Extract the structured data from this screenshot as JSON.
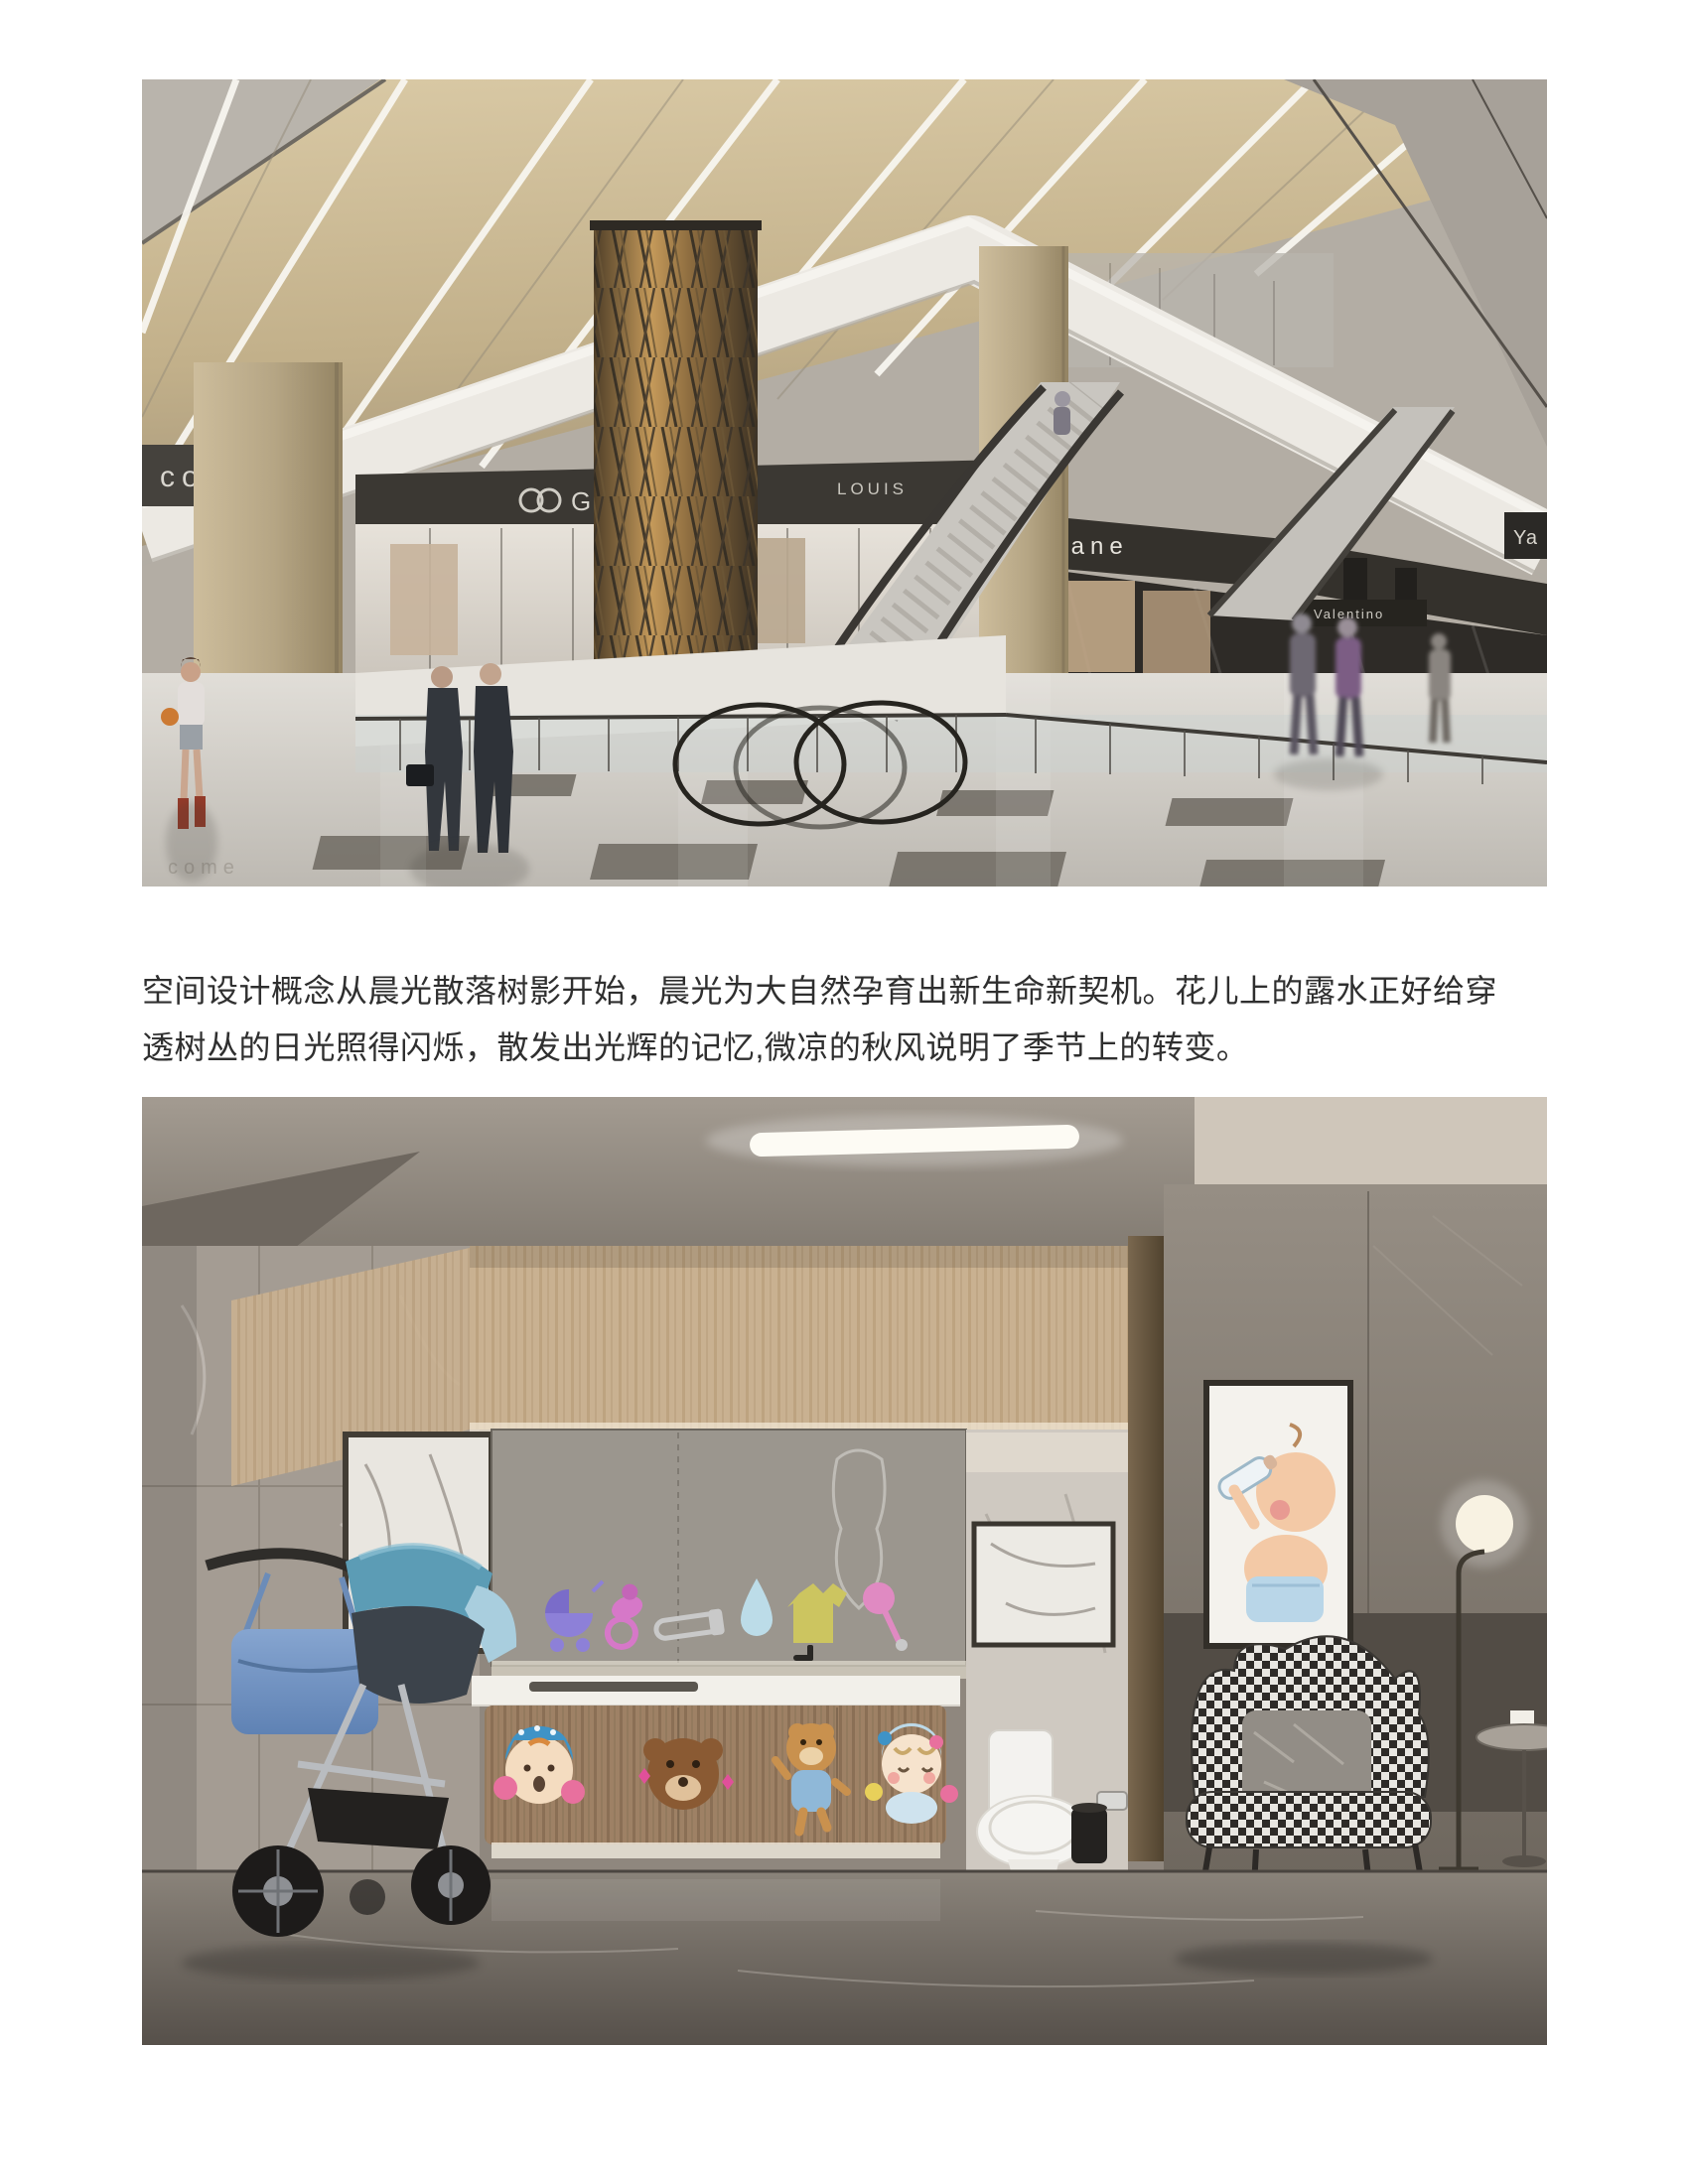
{
  "page": {
    "background": "#ffffff",
    "text_color": "#2f2f2f"
  },
  "content": {
    "paragraph": "空间设计概念从晨光散落树影开始，晨光为大自然孕育出新生命新契机。花儿上的露水正好给穿透树丛的日光照得闪烁，散发出光辉的记忆,微凉的秋风说明了季节上的转变。"
  },
  "mall_image": {
    "signs": {
      "welcome_partial": "come",
      "gucci": "GUCCI",
      "louis": "LOUIS",
      "chanel_partial": "Chane",
      "valentino": "Valentino",
      "corner_partial": "Ya"
    },
    "floor_reflection": "come",
    "colors": {
      "ceiling_beige": "#c9b68f",
      "bulkhead_white": "#ece9e3",
      "gold_column": "#8a6a3e",
      "fascia_dark": "#3b3833",
      "floor_light": "#dcd9d3",
      "inlay_tile": "#6f6a62"
    }
  },
  "baby_room_image": {
    "sticker_icons": [
      "pram-icon",
      "pacifier-icon",
      "safety-pin-icon",
      "water-drop-icon",
      "onesie-icon",
      "rattle-icon"
    ],
    "cabinet_characters": [
      "girl-in-winter-hat",
      "brown-bear-face",
      "bear-in-blue-shirt",
      "baby-in-blue-hat"
    ],
    "colors": {
      "wood_wall": "#c6ac8a",
      "sticker_panel": "#9b968e",
      "counter": "#f2f0ea",
      "cabinet_wood": "#9e8165",
      "floor": "#7e776f",
      "stroller_canopy": "#5c9cb5",
      "diaper_bag": "#7d9cc9",
      "chair_dark": "#2e2b28",
      "chair_light": "#e8e6e1"
    }
  }
}
